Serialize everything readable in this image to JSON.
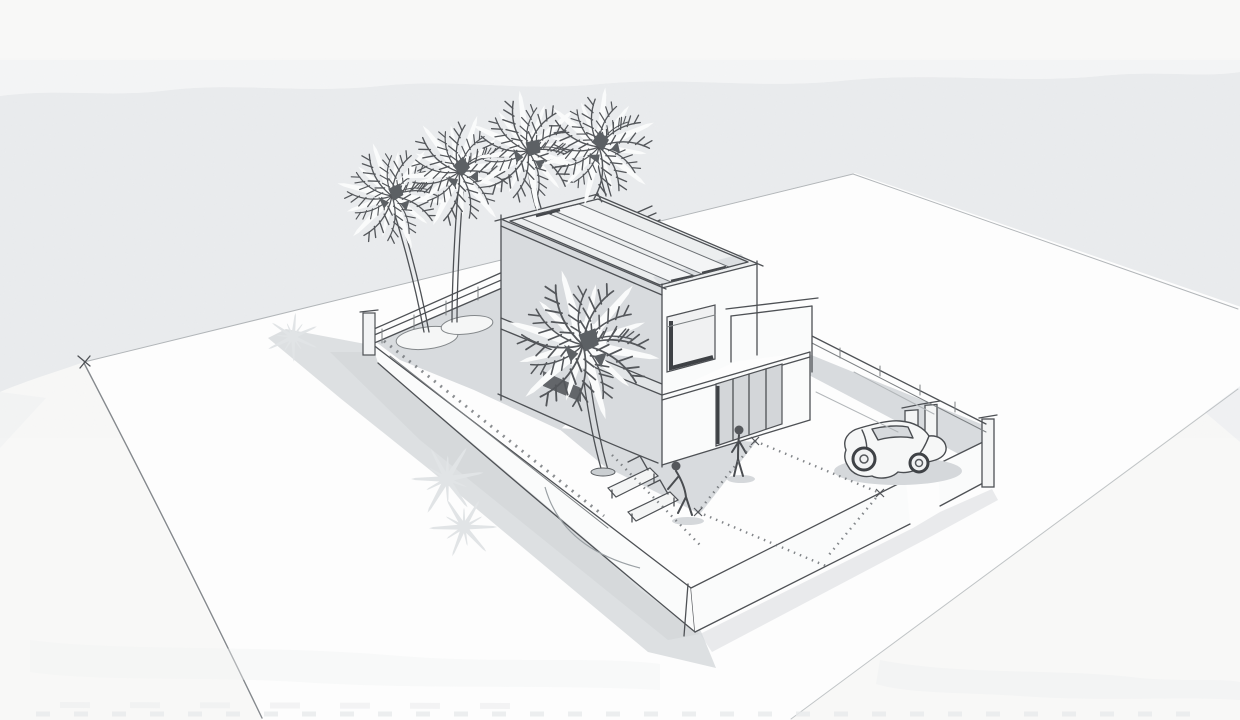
{
  "scene": {
    "title": "Architectural concept sketch",
    "description": "Hand-drawn aerial perspective sketch of a modern two-storey flat-roof villa on a walled plot: four tall palm trees behind the house, one palm in the courtyard, two sun loungers with a crouching figure, a standing figure at the sliding glass door, and a compact car parked on the driveway beside the entrance gate. Shadows fall to the lower left on white ground with a grey watercolor-wash sky.",
    "medium": "pencil and ink line sketch on light watercolor paper",
    "view": "three-quarter aerial perspective"
  },
  "objects": [
    {
      "id": "sky-wash",
      "label": "Grey watercolor wash sky with torn paper edge"
    },
    {
      "id": "ground-plane",
      "label": "White ground plane drawn as a perspective diamond"
    },
    {
      "id": "plot-shadow",
      "label": "Cast shadow of the walled plot falling to the south-west"
    },
    {
      "id": "palm-shadows",
      "label": "Starburst palm-frond shadows on the ground"
    },
    {
      "id": "plot",
      "label": "Walled rectangular plot with grey terrace and white paving"
    },
    {
      "id": "house",
      "label": "Two-storey flat-roof villa with roof deck panels"
    },
    {
      "id": "upper-window",
      "label": "Upper floor picture window"
    },
    {
      "id": "sliding-door",
      "label": "Ground floor sliding glass door"
    },
    {
      "id": "roof-terrace",
      "label": "First floor roof terrace parapet"
    },
    {
      "id": "rear-palms",
      "label": "Row of four tall palm trees behind the house"
    },
    {
      "id": "front-palm",
      "label": "Courtyard palm tree in front of the house"
    },
    {
      "id": "planters",
      "label": "Round planting beds at the palm bases"
    },
    {
      "id": "loungers",
      "label": "Two sun loungers on the terrace"
    },
    {
      "id": "standing-figure",
      "label": "Person standing at the sliding door"
    },
    {
      "id": "crouching-figure",
      "label": "Person crouching beside the loungers"
    },
    {
      "id": "car",
      "label": "Compact car parked on the driveway inside the gate"
    },
    {
      "id": "gate",
      "label": "Gate pillars at the driveway opening in the front wall"
    },
    {
      "id": "setting-out-lines",
      "label": "Tick-marked setting-out lines on the courtyard paving"
    }
  ],
  "palette": {
    "paper": "#f8f8f7",
    "sky_wash": "#eaecee",
    "ground_white": "#fdfdfd",
    "wall_shading": "#d8dbde",
    "shadow": "#d4d7da",
    "line": "#4e5155",
    "faint_line": "#b2b6b9",
    "dark_opening": "#63666a"
  }
}
